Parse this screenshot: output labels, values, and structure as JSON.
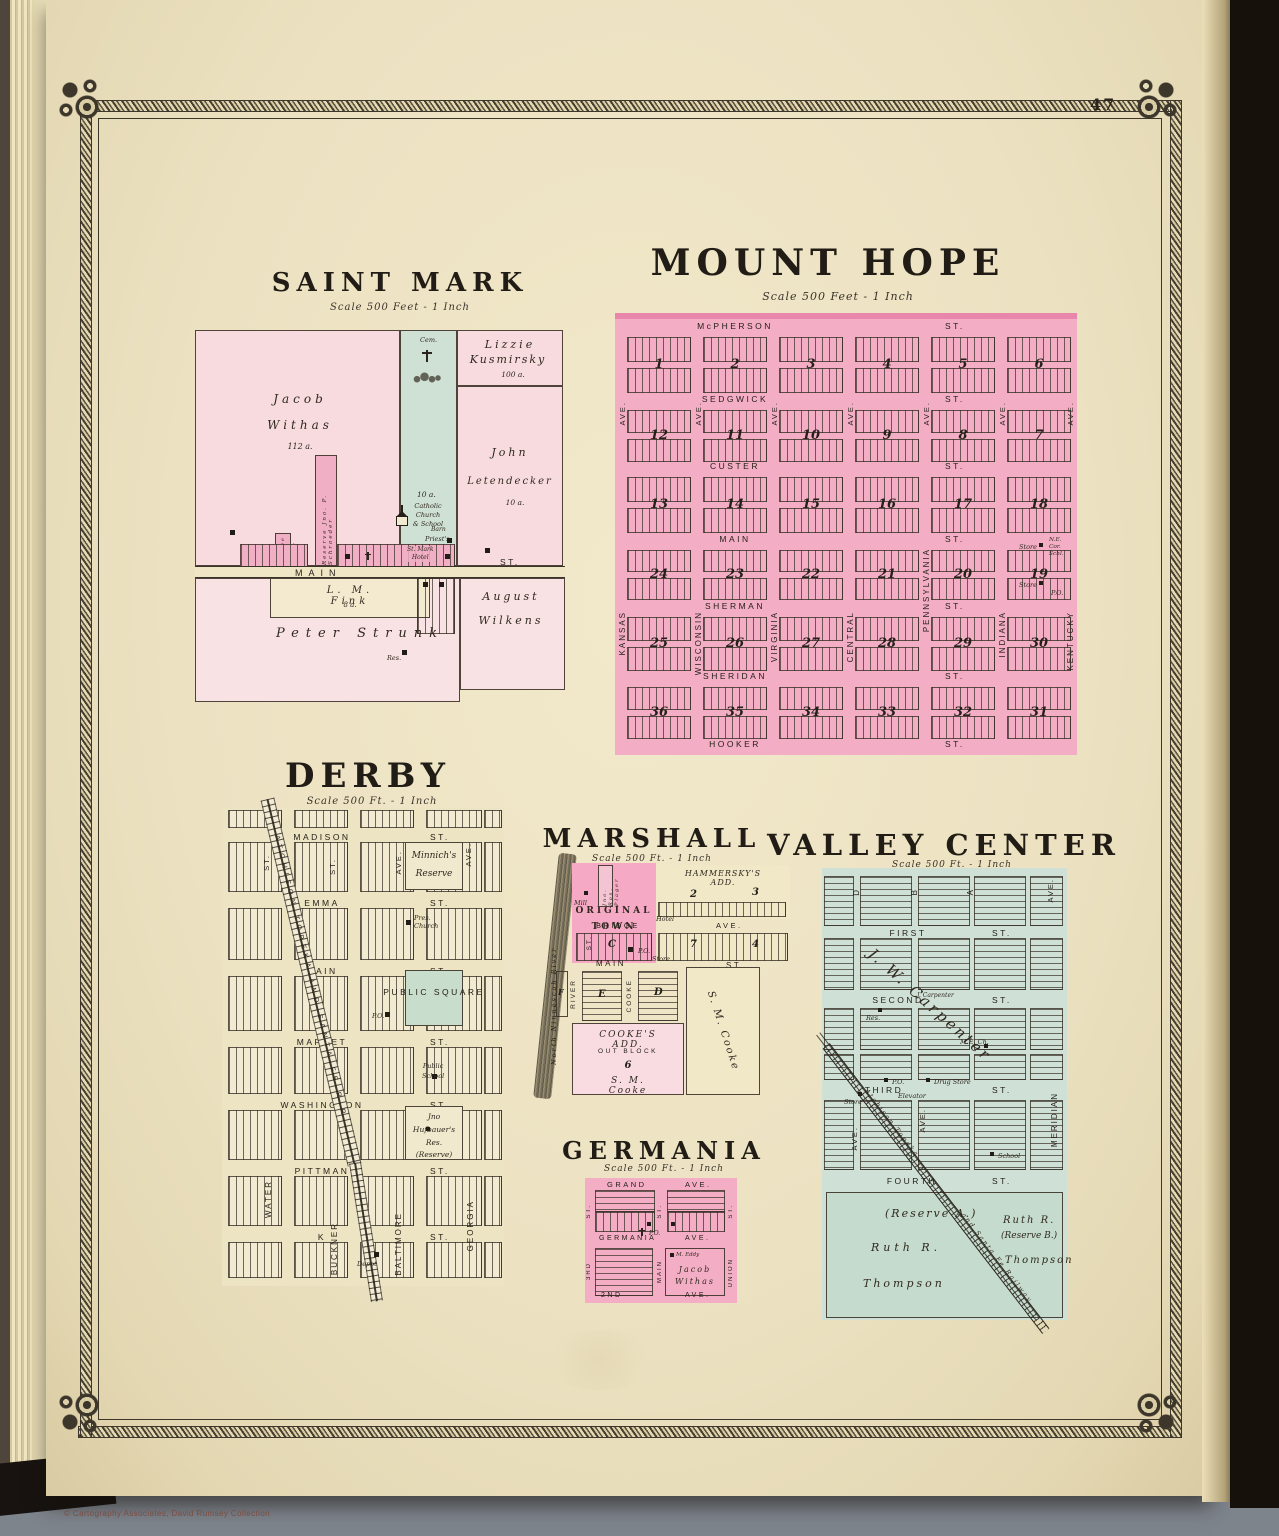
{
  "page": {
    "number": "47",
    "copyright": "© Cartography Associates, David Rumsey Collection"
  },
  "plats": {
    "saint_mark": {
      "title": "SAINT MARK",
      "scale": "Scale 500 Feet - 1 Inch",
      "withas_1": "Jacob",
      "withas_2": "Withas",
      "withas_acres": "112 a.",
      "cem": "Cem.",
      "strip_acres": "10 a.",
      "kusmirsky_1": "Lizzie",
      "kusmirsky_2": "Kusmirsky",
      "kusmirsky_acres": "100 a.",
      "letendecker_1": "John",
      "letendecker_2": "Letendecker",
      "letendecker_acres": "10 a.",
      "schroeder": "Reserve Jno. P. Schroeder",
      "stuber": "Reserve Wm. Stuber",
      "hotel": "St. Mark\nHotel",
      "church": "Catholic\nChurch\n& School",
      "barn": "Barn",
      "priest": "Priest's\nRes.",
      "main": "MAIN",
      "st": "ST.",
      "po": "P.O.",
      "fink": "L. M. Fink",
      "fink_acres": "8 a.",
      "strunk": "Peter Strunk",
      "res": "Res.",
      "wilkens_1": "August",
      "wilkens_2": "Wilkens"
    },
    "mount_hope": {
      "title": "MOUNT HOPE",
      "scale": "Scale 500 Feet - 1 Inch",
      "streets": [
        "McPHERSON",
        "SEDGWICK",
        "CUSTER",
        "MAIN",
        "SHERMAN",
        "SHERIDAN",
        "HOOKER"
      ],
      "st": "ST.",
      "ave": "AVE.",
      "avenues": [
        "KANSAS",
        "WISCONSIN",
        "VIRGINIA",
        "CENTRAL",
        "PENNSYLVANIA",
        "INDIANA",
        "KENTUCKY"
      ],
      "block_rows": [
        [
          1,
          2,
          3,
          4,
          5,
          6
        ],
        [
          12,
          11,
          10,
          9,
          8,
          7
        ],
        [
          13,
          14,
          15,
          16,
          17,
          18
        ],
        [
          24,
          23,
          22,
          21,
          20,
          19
        ],
        [
          25,
          26,
          27,
          28,
          29,
          30
        ],
        [
          36,
          35,
          34,
          33,
          32,
          31
        ]
      ],
      "store_1": "Store",
      "corner_note": "N.E.\nCor.\nSchl.",
      "store_2": "Store",
      "po": "P.O."
    },
    "derby": {
      "title": "DERBY",
      "scale": "Scale 500 Ft. - 1 Inch",
      "streets": [
        "MADISON",
        "EMMA",
        "MAIN",
        "MARKET",
        "WASHINGTON",
        "PITTMAN",
        "K"
      ],
      "st": "ST.",
      "upper_avenues": [
        "ST.",
        "ST.",
        "AVE.",
        "AVE."
      ],
      "avenues": [
        "WATER",
        "BUCKNER",
        "BALTIMORE",
        "GEORGIA"
      ],
      "minnich": "Minnich's\nReserve",
      "church": "Pres.\nChurch",
      "square": "PUBLIC\nSQUARE",
      "po": "P.O.",
      "school": "Public\nSchool",
      "hufbauer": "Jno Hufbauer's\nRes.\n(Reserve)",
      "depot": "Depot",
      "railroad": "ATCHISON TOPEKA AND SANTA FE R.R."
    },
    "marshall": {
      "title": "MARSHALL",
      "scale": "Scale 500 Ft. - 1 Inch",
      "river": "North Ninnescah River",
      "original_town": "ORIGINAL\nTOWN",
      "mill": "Mill",
      "plager": "Jno. Ros. Plager",
      "hammersky": "HAMMERSKY'S ADD.",
      "block_2": "2",
      "block_3": "3",
      "block_4": "4",
      "block_7": "7",
      "block_c": "C",
      "block_d": "D",
      "block_e": "E",
      "block_f": "F",
      "bridge": "BRIDGE",
      "ave": "AVE.",
      "hotel": "Hotel",
      "po": "P.O.",
      "store": "Store",
      "main": "MAIN",
      "st": "ST.",
      "elm": "ELM",
      "river_st": "RIVER",
      "cooke_st": "COOKE",
      "st_v": "ST.",
      "cookes_add": "COOKE'S ADD.",
      "out_block": "OUT BLOCK",
      "block_6": "6",
      "sm_cooke": "S. M. Cooke",
      "sm_cooke_panel": "S. M. Cooke"
    },
    "valley_center": {
      "title": "VALLEY CENTER",
      "scale": "Scale 500 Ft. - 1 Inch",
      "streets": [
        "FIRST",
        "SECOND",
        "THIRD",
        "FOURTH"
      ],
      "st": "ST.",
      "ave": "AVE.",
      "letters": [
        "D",
        "B",
        "A"
      ],
      "meridian": "MERIDIAN",
      "carpenter": "J. W. Carpenter",
      "carpenter_small": "J. Carpenter",
      "res": "Res.",
      "me_church": "M.E. Ch.",
      "store": "Store",
      "elevator": "Elevator",
      "po": "P.O.",
      "drug_store": "Drug Store",
      "school": "School",
      "reserve_a": "(Reserve A.)",
      "ruth_a": "Ruth R.",
      "thompson_a": "Thompson",
      "ruth_b": "Ruth R.",
      "reserve_b": "(Reserve B.)",
      "thompson_b": "Thompson",
      "rr_upper": "Atchison Topeka",
      "rr_lower": "and Santa Fe Railway"
    },
    "germania": {
      "title": "GERMANIA",
      "scale": "Scale 500 Ft. - 1 Inch",
      "grand": "GRAND",
      "ave": "AVE.",
      "germania_ave": "GERMANIA",
      "second_ave": "2ND",
      "st": "ST.",
      "third": "3RD",
      "main": "MAIN",
      "union": "UNION",
      "po": "P.O.",
      "eddy": "M. Eddy",
      "withas_1": "Jacob",
      "withas_2": "Withas"
    }
  }
}
